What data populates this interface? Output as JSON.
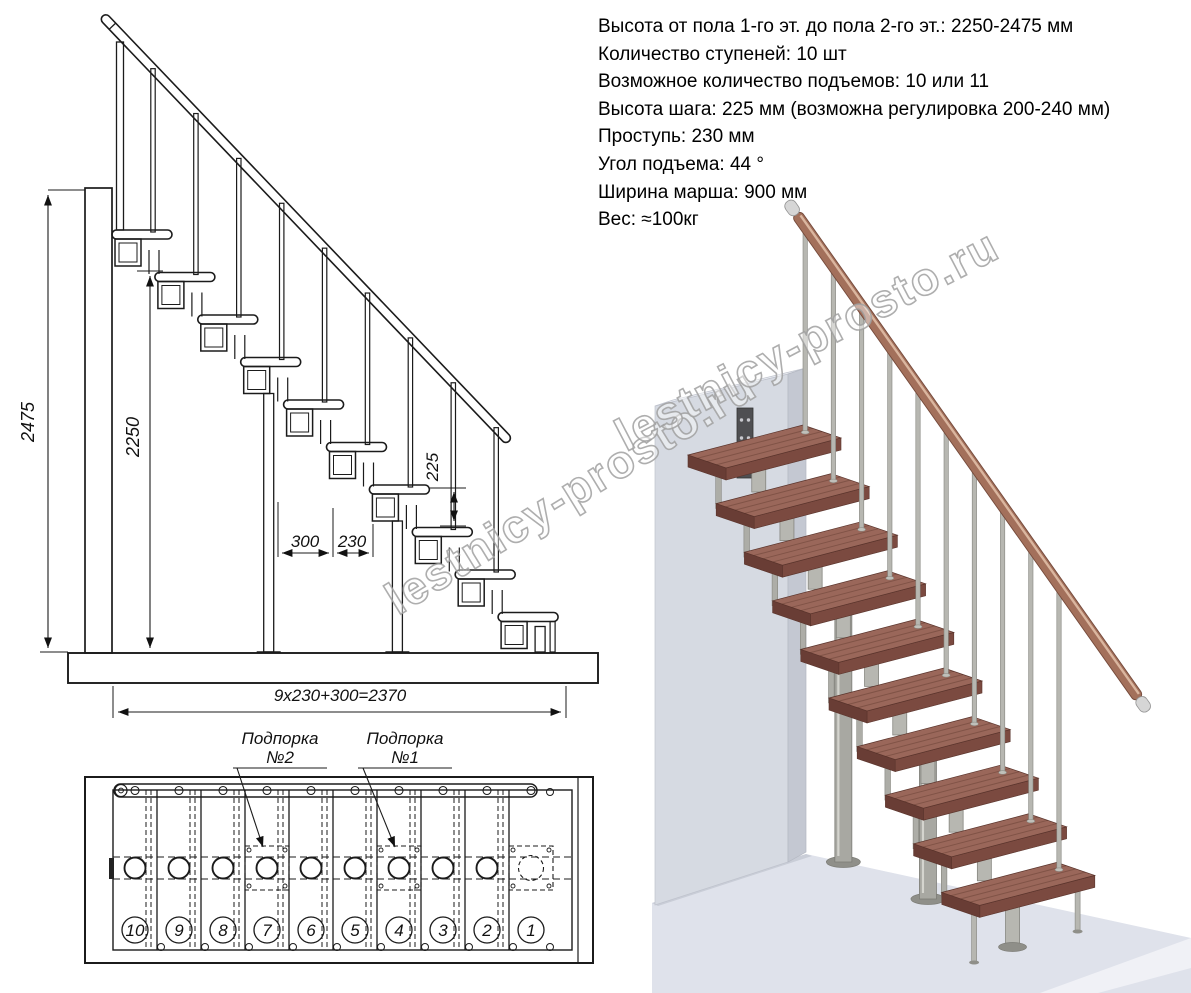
{
  "specs": {
    "lines": [
      "Высота от пола 1-го эт. до пола 2-го эт.: 2250-2475 мм",
      "Количество ступеней: 10 шт",
      "Возможное количество подъемов: 10 или 11",
      "Высота шага: 225 мм (возможна регулировка 200-240 мм)",
      "Проступь: 230 мм",
      "Угол подъема: 44 °",
      "Ширина марша: 900 мм",
      "Вес: ≈100кг"
    ]
  },
  "side_view": {
    "dims": {
      "total_height": "2475",
      "clear_height": "2250",
      "rise": "225",
      "run_300": "300",
      "run_230": "230",
      "total_run": "9x230+300=2370"
    }
  },
  "plan_view": {
    "support2": {
      "line1": "Подпорка",
      "line2": "№2"
    },
    "support1": {
      "line1": "Подпорка",
      "line2": "№1"
    },
    "step_numbers": [
      "10",
      "9",
      "8",
      "7",
      "6",
      "5",
      "4",
      "3",
      "2",
      "1"
    ]
  },
  "watermark": {
    "text": "lestnicy-prosto.ru"
  },
  "colors": {
    "tread_top": "#9a675a",
    "tread_front": "#7b4a40",
    "tread_side": "#693d35",
    "metal": "#b7b7b1",
    "metal_edge": "#85857f",
    "column": "#a8a8a2",
    "column_edge": "#7d7d77",
    "base": "#8f8f89",
    "rail_wood": "#a3705b",
    "rail_edge": "#74493a",
    "ferrule": "#d6d6d6",
    "wall_front": "#d6dae2",
    "wall_top": "#eceef3",
    "wall_side": "#c4c8d2",
    "floor_top": "#dfe2eb",
    "floor_front": "#f0f1f6",
    "plate_dark": "#4f4f52"
  }
}
